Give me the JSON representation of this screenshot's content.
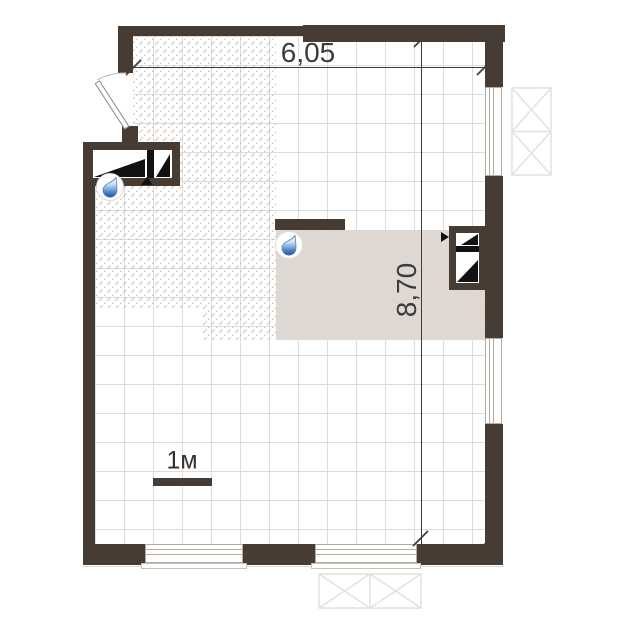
{
  "plan": {
    "kind": "apartment-floor-plan"
  },
  "dimensions": {
    "width": {
      "label": "6,05"
    },
    "height": {
      "label": "8,70"
    }
  },
  "scale": {
    "label": "1м"
  },
  "colors": {
    "wall": "#473c33",
    "zone": "#ded7d2",
    "hatch": "#c9bfb5",
    "grid": "#dcdcdc",
    "dim": "#3c3c3c",
    "winframe": "#b3aba2",
    "balcony": "#e4e1dd",
    "dropdark": "#2a5491",
    "droplight": "#cfe0f2"
  },
  "icons": {
    "water_drop": "water-drop-icon",
    "vent_shaft": "vent-shaft-icon",
    "direction_arrow": "direction-arrow-icon",
    "door_swing": "door-swing-arc"
  }
}
